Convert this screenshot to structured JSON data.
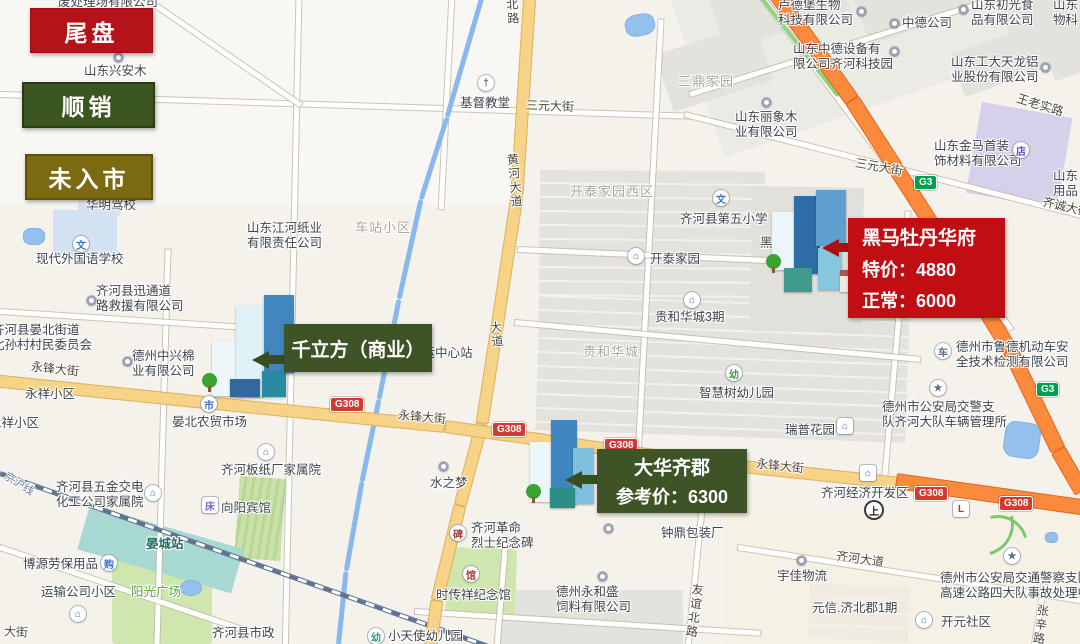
{
  "legend": {
    "items": [
      {
        "label": "尾盘",
        "type": "red",
        "color": "#b5121a"
      },
      {
        "label": "顺销",
        "type": "green",
        "color": "#3c5621"
      },
      {
        "label": "未入市",
        "type": "olive",
        "color": "#7c6a10"
      }
    ]
  },
  "callouts": [
    {
      "name": "黑马牡丹华府",
      "lines": [
        "特价：4880",
        "正常：6000"
      ],
      "color": "#c00e13"
    },
    {
      "name": "千立方（商业）",
      "lines": [],
      "color": "#3e5326"
    },
    {
      "name": "大华齐郡",
      "lines": [
        "参考价：6300"
      ],
      "color": "#3e5326"
    }
  ],
  "map": {
    "labels": [
      {
        "t": "废处理场有限公司",
        "x": 58,
        "y": -5,
        "cls": "poi"
      },
      {
        "t": "山东兴安木",
        "x": 84,
        "y": 64,
        "cls": "poi"
      },
      {
        "t": "华明驾校",
        "x": 86,
        "y": 198,
        "cls": "poi"
      },
      {
        "t": "基督教堂",
        "x": 460,
        "y": 96,
        "cls": "poi"
      },
      {
        "t": "现代外国语学校",
        "x": 36,
        "y": 252,
        "cls": "poi"
      },
      {
        "t": "山东江河纸业\n有限责任公司",
        "x": 247,
        "y": 221,
        "cls": "poi"
      },
      {
        "t": "齐河县迅通道\n路救援有限公司",
        "x": 96,
        "y": 284,
        "cls": "poi"
      },
      {
        "t": "齐河县晏北街道\n北孙村村民委员会",
        "x": -8,
        "y": 323,
        "cls": "poi"
      },
      {
        "t": "德州中兴棉\n业有限公司",
        "x": 132,
        "y": 349,
        "cls": "poi"
      },
      {
        "t": "晏北农贸市场",
        "x": 172,
        "y": 415,
        "cls": "poi"
      },
      {
        "t": "齐河板纸厂家属院",
        "x": 221,
        "y": 463,
        "cls": "poi"
      },
      {
        "t": "齐河县五金交电\n化工公司家属院",
        "x": 56,
        "y": 480,
        "cls": "poi"
      },
      {
        "t": "向阳宾馆",
        "x": 221,
        "y": 501,
        "cls": "poi"
      },
      {
        "t": "博源劳保用品",
        "x": 23,
        "y": 557,
        "cls": "poi"
      },
      {
        "t": "运输公司小区",
        "x": 41,
        "y": 585,
        "cls": "poi"
      },
      {
        "t": "齐河县市政",
        "x": 212,
        "y": 626,
        "cls": "poi"
      },
      {
        "t": "小天使幼儿园",
        "x": 388,
        "y": 629,
        "cls": "poi"
      },
      {
        "t": "阳光广场",
        "x": 131,
        "y": 585,
        "cls": "green-l"
      },
      {
        "t": "晏城站",
        "x": 146,
        "y": 537,
        "cls": "teal-l"
      },
      {
        "t": "水之梦",
        "x": 430,
        "y": 476,
        "cls": "poi"
      },
      {
        "t": "齐河客运中心站",
        "x": 385,
        "y": 346,
        "cls": "poi"
      },
      {
        "t": "齐河革命\n烈士纪念碑",
        "x": 471,
        "y": 521,
        "cls": "poi"
      },
      {
        "t": "时传祥纪念馆",
        "x": 436,
        "y": 588,
        "cls": "poi"
      },
      {
        "t": "德州永和盛\n饲料有限公司",
        "x": 556,
        "y": 585,
        "cls": "poi"
      },
      {
        "t": "钟鼎包装厂",
        "x": 661,
        "y": 526,
        "cls": "poi"
      },
      {
        "t": "宇佳物流",
        "x": 777,
        "y": 569,
        "cls": "poi"
      },
      {
        "t": "开元社区",
        "x": 941,
        "y": 615,
        "cls": "poi"
      },
      {
        "t": "德州市公安局交通警察支队\n高速公路四大队事故处理中",
        "x": 940,
        "y": 571,
        "cls": "poi"
      },
      {
        "t": "德州市公安局交警支\n队齐河大队车辆管理所",
        "x": 882,
        "y": 400,
        "cls": "poi"
      },
      {
        "t": "德州市鲁德机动车安\n全技术检测有限公司",
        "x": 956,
        "y": 340,
        "cls": "poi"
      },
      {
        "t": "瑞普花园",
        "x": 785,
        "y": 423,
        "cls": "poi"
      },
      {
        "t": "智慧树幼儿园",
        "x": 699,
        "y": 386,
        "cls": "poi"
      },
      {
        "t": "贵和华城3期",
        "x": 655,
        "y": 310,
        "cls": "poi"
      },
      {
        "t": "开泰家园",
        "x": 650,
        "y": 252,
        "cls": "poi"
      },
      {
        "t": "齐河县第五小学",
        "x": 680,
        "y": 212,
        "cls": "poi"
      },
      {
        "t": "中德公司",
        "x": 902,
        "y": 16,
        "cls": "poi"
      },
      {
        "t": "卢德堡生物\n科技有限公司",
        "x": 778,
        "y": -2,
        "cls": "poi"
      },
      {
        "t": "山东初光食\n品有限公司",
        "x": 971,
        "y": -2,
        "cls": "poi"
      },
      {
        "t": "山东\n物科",
        "x": 1053,
        "y": -2,
        "cls": "poi"
      },
      {
        "t": "山东中德设备有\n限公司齐河科技园",
        "x": 793,
        "y": 42,
        "cls": "poi"
      },
      {
        "t": "山东工大天龙铝\n业股份有限公司",
        "x": 951,
        "y": 55,
        "cls": "poi"
      },
      {
        "t": "山东丽象木\n业有限公司",
        "x": 735,
        "y": 110,
        "cls": "poi"
      },
      {
        "t": "山东金马首装\n饰材料有限公司",
        "x": 934,
        "y": 139,
        "cls": "poi"
      },
      {
        "t": "山东\n用品",
        "x": 1053,
        "y": 169,
        "cls": "poi"
      },
      {
        "t": "齐河经济开发区",
        "x": 821,
        "y": 486,
        "cls": "poi"
      },
      {
        "t": "黑马",
        "x": 760,
        "y": 236,
        "cls": "poi under"
      },
      {
        "t": "开泰家园西区",
        "x": 570,
        "y": 184,
        "cls": "area"
      },
      {
        "t": "贵和华城",
        "x": 583,
        "y": 344,
        "cls": "area"
      },
      {
        "t": "三鼎家园",
        "x": 678,
        "y": 74,
        "cls": "area"
      },
      {
        "t": "车站小区",
        "x": 355,
        "y": 220,
        "cls": "area"
      },
      {
        "t": "永祥小区",
        "x": 25,
        "y": 387,
        "cls": "poi"
      },
      {
        "t": "永祥小区",
        "x": -11,
        "y": 416,
        "cls": "poi"
      },
      {
        "t": "元信.济北郡1期",
        "x": 812,
        "y": 601,
        "cls": "poi"
      },
      {
        "t": "三元大街",
        "x": 526,
        "y": 99,
        "cls": "road",
        "rot": 2
      },
      {
        "t": "三元大街",
        "x": 855,
        "y": 160,
        "cls": "road",
        "rot": 10
      },
      {
        "t": "北路",
        "x": 505,
        "y": -2,
        "cls": "roadv",
        "rot": -4
      },
      {
        "t": "黄河大道",
        "x": 507,
        "y": 153,
        "cls": "roadv",
        "rot": -5
      },
      {
        "t": "大道",
        "x": 489,
        "y": 321,
        "cls": "roadv",
        "rot": -6
      },
      {
        "t": "永锋大街",
        "x": 31,
        "y": 362,
        "cls": "road",
        "rot": 6
      },
      {
        "t": "永锋大街",
        "x": 398,
        "y": 410,
        "cls": "road",
        "rot": 5
      },
      {
        "t": "永锋大街",
        "x": 756,
        "y": 459,
        "cls": "road",
        "rot": 6
      },
      {
        "t": "齐河大道",
        "x": 836,
        "y": 552,
        "cls": "road",
        "rot": 8
      },
      {
        "t": "友谊北路",
        "x": 687,
        "y": 583,
        "cls": "roadv",
        "rot": 8
      },
      {
        "t": "张辛路",
        "x": 1033,
        "y": 604,
        "cls": "roadv",
        "rot": 8
      },
      {
        "t": "王老实路",
        "x": 1016,
        "y": 98,
        "cls": "road",
        "rot": 17
      },
      {
        "t": "齐诚大街",
        "x": 1042,
        "y": 200,
        "cls": "road",
        "rot": 13
      },
      {
        "t": "京沪线",
        "x": 2,
        "y": 478,
        "cls": "rail-l",
        "rot": 32
      },
      {
        "t": "大街",
        "x": 4,
        "y": 625,
        "cls": "road",
        "rot": 3
      }
    ],
    "icons": [
      {
        "x": 478,
        "y": 75,
        "g": "†",
        "fg": "#8a4a38",
        "shape": "c",
        "n": "church-icon"
      },
      {
        "x": 73,
        "y": 236,
        "g": "文",
        "fg": "#3b6fd1",
        "shape": "c",
        "n": "school-icon"
      },
      {
        "x": 713,
        "y": 190,
        "g": "文",
        "fg": "#3b6fd1",
        "shape": "c",
        "n": "school-icon"
      },
      {
        "x": 628,
        "y": 248,
        "g": "⌂",
        "fg": "#3b6fd1",
        "shape": "c",
        "n": "house-icon"
      },
      {
        "x": 684,
        "y": 292,
        "g": "⌂",
        "fg": "#3b6fd1",
        "shape": "c",
        "n": "house-icon"
      },
      {
        "x": 837,
        "y": 418,
        "g": "⌂",
        "fg": "#3b6fd1",
        "shape": "s",
        "n": "building-icon"
      },
      {
        "x": 201,
        "y": 396,
        "g": "市",
        "fg": "#3b6fd1",
        "shape": "c",
        "n": "market-icon"
      },
      {
        "x": 258,
        "y": 444,
        "g": "⌂",
        "fg": "#3b6fd1",
        "shape": "c",
        "n": "house-icon"
      },
      {
        "x": 145,
        "y": 485,
        "g": "⌂",
        "fg": "#3b6fd1",
        "shape": "c",
        "n": "house-icon"
      },
      {
        "x": 202,
        "y": 497,
        "g": "床",
        "fg": "#7b68d8",
        "shape": "s",
        "n": "hotel-icon"
      },
      {
        "x": 101,
        "y": 555,
        "g": "购",
        "fg": "#3b6fd1",
        "shape": "c",
        "n": "cart-icon"
      },
      {
        "x": 70,
        "y": 606,
        "g": "⌂",
        "fg": "#3b6fd1",
        "shape": "c",
        "n": "house-icon"
      },
      {
        "x": 368,
        "y": 628,
        "g": "幼",
        "fg": "#2e9a8f",
        "shape": "c",
        "n": "kindergarten-icon"
      },
      {
        "x": 450,
        "y": 525,
        "g": "碑",
        "fg": "#a03f35",
        "shape": "c",
        "n": "monument-icon"
      },
      {
        "x": 463,
        "y": 566,
        "g": "馆",
        "fg": "#a03f35",
        "shape": "c",
        "n": "museum-icon"
      },
      {
        "x": 916,
        "y": 612,
        "g": "⌂",
        "fg": "#3b6fd1",
        "shape": "c",
        "n": "house-icon"
      },
      {
        "x": 1004,
        "y": 548,
        "g": "★",
        "fg": "#5b718c",
        "shape": "c",
        "n": "star-icon"
      },
      {
        "x": 930,
        "y": 380,
        "g": "★",
        "fg": "#5b718c",
        "shape": "c",
        "n": "star-icon"
      },
      {
        "x": 935,
        "y": 343,
        "g": "车",
        "fg": "#5b718c",
        "shape": "c",
        "n": "car-icon"
      },
      {
        "x": 1013,
        "y": 142,
        "g": "店",
        "fg": "#4f51c8",
        "shape": "c",
        "n": "shop-icon"
      },
      {
        "x": 726,
        "y": 365,
        "g": "幼",
        "fg": "#3f9b45",
        "shape": "c",
        "n": "kindergarten-icon"
      },
      {
        "x": 860,
        "y": 465,
        "g": "⌂",
        "fg": "#3b6fd1",
        "shape": "s",
        "n": "building-icon"
      },
      {
        "x": 866,
        "y": 502,
        "g": "上",
        "fg": "#222222",
        "shape": "c",
        "ring": 1,
        "n": "highway-entrance-icon"
      },
      {
        "x": 953,
        "y": 501,
        "g": "L",
        "fg": "#dd2222",
        "shape": "s",
        "n": "driving-school-icon"
      },
      {
        "x": 114,
        "y": 53,
        "dot": 1,
        "n": "poi-dot"
      },
      {
        "x": 87,
        "y": 296,
        "dot": 1,
        "n": "poi-dot"
      },
      {
        "x": 123,
        "y": 357,
        "dot": 1,
        "n": "poi-dot"
      },
      {
        "x": 439,
        "y": 462,
        "dot": 1,
        "n": "poi-dot"
      },
      {
        "x": 598,
        "y": 572,
        "dot": 1,
        "n": "poi-dot"
      },
      {
        "x": 604,
        "y": 524,
        "dot": 1,
        "n": "poi-dot"
      },
      {
        "x": 797,
        "y": 556,
        "dot": 1,
        "n": "poi-dot"
      },
      {
        "x": 890,
        "y": 19,
        "dot": 1,
        "n": "poi-dot"
      },
      {
        "x": 857,
        "y": 7,
        "dot": 1,
        "n": "poi-dot"
      },
      {
        "x": 959,
        "y": 5,
        "dot": 1,
        "n": "poi-dot"
      },
      {
        "x": 890,
        "y": 47,
        "dot": 1,
        "n": "poi-dot"
      },
      {
        "x": 1041,
        "y": 63,
        "dot": 1,
        "n": "poi-dot"
      },
      {
        "x": 762,
        "y": 98,
        "dot": 1,
        "n": "poi-dot"
      }
    ],
    "badges": [
      {
        "x": 330,
        "y": 397,
        "t": "G308",
        "type": "g308"
      },
      {
        "x": 492,
        "y": 422,
        "t": "G308",
        "type": "g308"
      },
      {
        "x": 604,
        "y": 438,
        "t": "G308",
        "type": "g308"
      },
      {
        "x": 914,
        "y": 486,
        "t": "G308",
        "type": "g308"
      },
      {
        "x": 999,
        "y": 496,
        "t": "G308",
        "type": "g308"
      },
      {
        "x": 914,
        "y": 175,
        "t": "G3",
        "type": "g3"
      },
      {
        "x": 1036,
        "y": 382,
        "t": "G3",
        "type": "g3"
      }
    ]
  }
}
